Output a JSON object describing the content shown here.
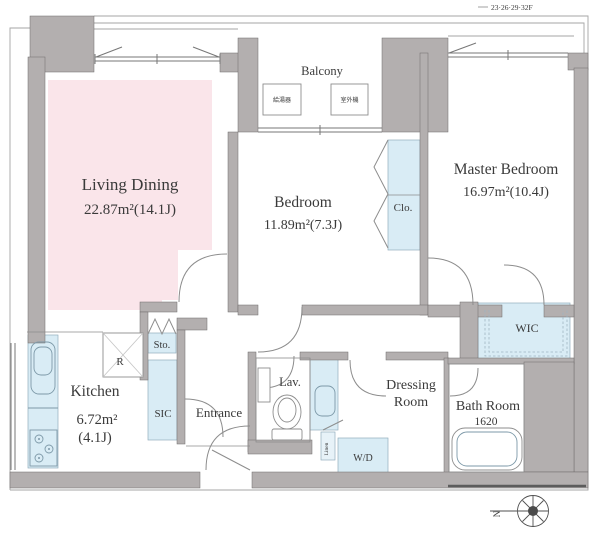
{
  "title_block": {
    "floor_label": "23·26·29·32F"
  },
  "balcony": {
    "label": "Balcony",
    "equipment_box_1": "給湯器",
    "equipment_box_2": "室外機"
  },
  "rooms": {
    "living_dining": {
      "name": "Living Dining",
      "area": "22.87m²(14.1J)"
    },
    "bedroom": {
      "name": "Bedroom",
      "area": "11.89m²(7.3J)"
    },
    "master_bedroom": {
      "name": "Master Bedroom",
      "area": "16.97m²(10.4J)"
    },
    "kitchen": {
      "name": "Kitchen",
      "area_line1": "6.72m²",
      "area_line2": "(4.1J)"
    },
    "entrance": {
      "name": "Entrance"
    },
    "lavatory": {
      "name": "Lav."
    },
    "dressing_room": {
      "line1": "Dressing",
      "line2": "Room"
    },
    "bath_room": {
      "name": "Bath Room",
      "size": "1620"
    },
    "wic": {
      "name": "WIC"
    },
    "sic": {
      "name": "SIC"
    },
    "storage": {
      "name": "Sto."
    },
    "closet": {
      "name": "Clo."
    },
    "washer_dryer": {
      "name": "W/D"
    },
    "linen": {
      "name": "Linen"
    },
    "refrigerator": {
      "name": "R"
    }
  },
  "compass": {
    "north": "N"
  },
  "colors": {
    "living_fill": "#fae5ea",
    "closet_fill": "#d9ecf5",
    "wall": "#b3afaf"
  }
}
